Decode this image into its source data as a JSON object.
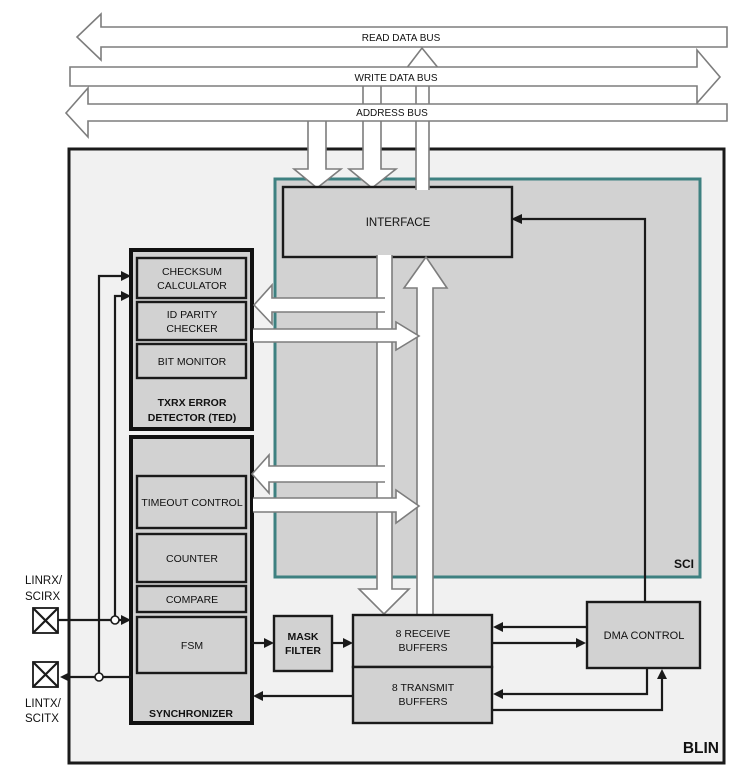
{
  "colors": {
    "background": "#ffffff",
    "blin_fill": "#f1f1f1",
    "block_fill": "#d2d2d2",
    "sci_border": "#3e8181",
    "line_color": "#1a1a1a",
    "bus_outline": "#7d7d7d"
  },
  "buses": {
    "read": "READ DATA BUS",
    "write": "WRITE DATA BUS",
    "address": "ADDRESS BUS"
  },
  "regions": {
    "blin": "BLIN",
    "sci": "SCI"
  },
  "blocks": {
    "interface": {
      "label": "INTERFACE"
    },
    "ted": {
      "line1": "TXRX ERROR",
      "line2": "DETECTOR (TED)",
      "checksum": {
        "line1": "CHECKSUM",
        "line2": "CALCULATOR"
      },
      "id_parity": {
        "line1": "ID PARITY",
        "line2": "CHECKER"
      },
      "bit_monitor": {
        "label": "BIT MONITOR"
      }
    },
    "synchronizer": {
      "label": "SYNCHRONIZER",
      "timeout": {
        "label": "TIMEOUT CONTROL"
      },
      "counter": {
        "label": "COUNTER"
      },
      "compare": {
        "label": "COMPARE"
      },
      "fsm": {
        "label": "FSM"
      }
    },
    "mask_filter": {
      "line1": "MASK",
      "line2": "FILTER"
    },
    "receive_buffers": {
      "line1": "8 RECEIVE",
      "line2": "BUFFERS"
    },
    "transmit_buffers": {
      "line1": "8 TRANSMIT",
      "line2": "BUFFERS"
    },
    "dma": {
      "label": "DMA CONTROL"
    }
  },
  "pins": {
    "rx": {
      "line1": "LINRX/",
      "line2": "SCIRX"
    },
    "tx": {
      "line1": "LINTX/",
      "line2": "SCITX"
    }
  }
}
